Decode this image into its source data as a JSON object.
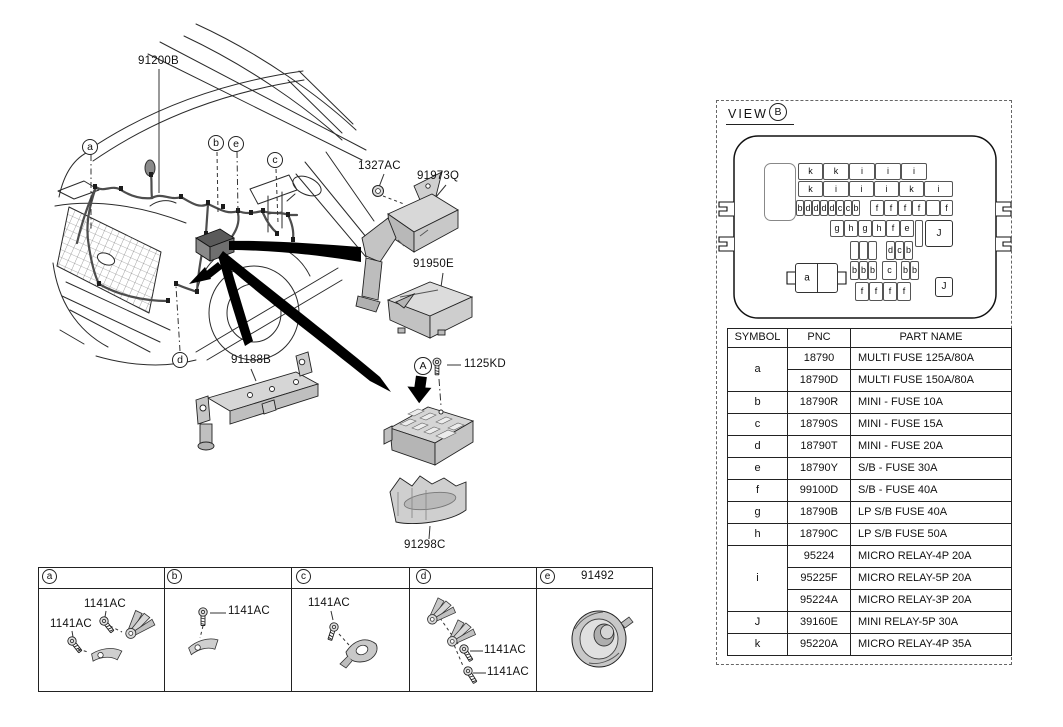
{
  "diagram": {
    "labels": {
      "harness": "91200B",
      "front_bracket": "91188B",
      "nut": "1327AC",
      "upper_bracket": "91973Q",
      "upper_cover": "91950E",
      "mounting_bolt": "1125KD",
      "lower_cover": "91298C"
    },
    "callouts": {
      "car": [
        "a",
        "b",
        "e",
        "c",
        "d"
      ],
      "assembly_point": "A"
    }
  },
  "view_panel": {
    "title": "VIEW",
    "view_letter": "B",
    "battery_label": "a",
    "fuse_cells": [
      {
        "l": "k",
        "x": 798,
        "y": 163,
        "w": 25,
        "h": 17
      },
      {
        "l": "k",
        "x": 823,
        "y": 163,
        "w": 26,
        "h": 17
      },
      {
        "l": "i",
        "x": 849,
        "y": 163,
        "w": 26,
        "h": 17
      },
      {
        "l": "i",
        "x": 875,
        "y": 163,
        "w": 26,
        "h": 17
      },
      {
        "l": "i",
        "x": 901,
        "y": 163,
        "w": 26,
        "h": 17
      },
      {
        "l": "k",
        "x": 798,
        "y": 181,
        "w": 25,
        "h": 16
      },
      {
        "l": "i",
        "x": 823,
        "y": 181,
        "w": 26,
        "h": 16
      },
      {
        "l": "i",
        "x": 849,
        "y": 181,
        "w": 25,
        "h": 16
      },
      {
        "l": "i",
        "x": 874,
        "y": 181,
        "w": 25,
        "h": 16
      },
      {
        "l": "k",
        "x": 899,
        "y": 181,
        "w": 25,
        "h": 16
      },
      {
        "l": "i",
        "x": 924,
        "y": 181,
        "w": 29,
        "h": 16
      },
      {
        "l": "b",
        "x": 796,
        "y": 200,
        "w": 8,
        "h": 16
      },
      {
        "l": "d",
        "x": 804,
        "y": 200,
        "w": 8,
        "h": 16
      },
      {
        "l": "d",
        "x": 812,
        "y": 200,
        "w": 8,
        "h": 16
      },
      {
        "l": "d",
        "x": 820,
        "y": 200,
        "w": 8,
        "h": 16
      },
      {
        "l": "d",
        "x": 828,
        "y": 200,
        "w": 8,
        "h": 16
      },
      {
        "l": "c",
        "x": 836,
        "y": 200,
        "w": 8,
        "h": 16
      },
      {
        "l": "c",
        "x": 844,
        "y": 200,
        "w": 8,
        "h": 16
      },
      {
        "l": "b",
        "x": 852,
        "y": 200,
        "w": 8,
        "h": 16
      },
      {
        "l": "f",
        "x": 870,
        "y": 200,
        "w": 14,
        "h": 16
      },
      {
        "l": "f",
        "x": 884,
        "y": 200,
        "w": 14,
        "h": 16
      },
      {
        "l": "f",
        "x": 898,
        "y": 200,
        "w": 14,
        "h": 16
      },
      {
        "l": "f",
        "x": 912,
        "y": 200,
        "w": 14,
        "h": 16
      },
      {
        "l": "",
        "x": 926,
        "y": 200,
        "w": 14,
        "h": 16
      },
      {
        "l": "f",
        "x": 940,
        "y": 200,
        "w": 13,
        "h": 16
      },
      {
        "l": "g",
        "x": 830,
        "y": 220,
        "w": 14,
        "h": 17
      },
      {
        "l": "h",
        "x": 844,
        "y": 220,
        "w": 14,
        "h": 17
      },
      {
        "l": "g",
        "x": 858,
        "y": 220,
        "w": 14,
        "h": 17
      },
      {
        "l": "h",
        "x": 872,
        "y": 220,
        "w": 14,
        "h": 17
      },
      {
        "l": "f",
        "x": 886,
        "y": 220,
        "w": 14,
        "h": 17
      },
      {
        "l": "e",
        "x": 900,
        "y": 220,
        "w": 14,
        "h": 17
      },
      {
        "l": "",
        "x": 915,
        "y": 220,
        "w": 8,
        "h": 27
      },
      {
        "l": "J",
        "x": 925,
        "y": 220,
        "w": 28,
        "h": 27,
        "j": true
      },
      {
        "l": "",
        "x": 850,
        "y": 241,
        "w": 9,
        "h": 19
      },
      {
        "l": "",
        "x": 859,
        "y": 241,
        "w": 9,
        "h": 19
      },
      {
        "l": "",
        "x": 868,
        "y": 241,
        "w": 9,
        "h": 19
      },
      {
        "l": "d",
        "x": 886,
        "y": 241,
        "w": 9,
        "h": 19
      },
      {
        "l": "c",
        "x": 895,
        "y": 241,
        "w": 9,
        "h": 19
      },
      {
        "l": "b",
        "x": 904,
        "y": 241,
        "w": 9,
        "h": 19
      },
      {
        "l": "b",
        "x": 850,
        "y": 261,
        "w": 9,
        "h": 19
      },
      {
        "l": "b",
        "x": 859,
        "y": 261,
        "w": 9,
        "h": 19
      },
      {
        "l": "b",
        "x": 868,
        "y": 261,
        "w": 9,
        "h": 19
      },
      {
        "l": "c",
        "x": 882,
        "y": 261,
        "w": 15,
        "h": 19
      },
      {
        "l": "b",
        "x": 901,
        "y": 261,
        "w": 9,
        "h": 19
      },
      {
        "l": "b",
        "x": 910,
        "y": 261,
        "w": 9,
        "h": 19
      },
      {
        "l": "f",
        "x": 855,
        "y": 282,
        "w": 14,
        "h": 19
      },
      {
        "l": "f",
        "x": 869,
        "y": 282,
        "w": 14,
        "h": 19
      },
      {
        "l": "f",
        "x": 883,
        "y": 282,
        "w": 14,
        "h": 19
      },
      {
        "l": "f",
        "x": 897,
        "y": 282,
        "w": 14,
        "h": 19
      },
      {
        "l": "J",
        "x": 935,
        "y": 277,
        "w": 18,
        "h": 20,
        "j": true
      }
    ],
    "table": {
      "headers": [
        "SYMBOL",
        "PNC",
        "PART NAME"
      ],
      "rows": [
        {
          "symbol": "a",
          "span": 2,
          "pnc": "18790",
          "name": "MULTI FUSE 125A/80A"
        },
        {
          "pnc": "18790D",
          "name": "MULTI FUSE 150A/80A"
        },
        {
          "symbol": "b",
          "span": 1,
          "pnc": "18790R",
          "name": "MINI - FUSE 10A"
        },
        {
          "symbol": "c",
          "span": 1,
          "pnc": "18790S",
          "name": "MINI - FUSE 15A"
        },
        {
          "symbol": "d",
          "span": 1,
          "pnc": "18790T",
          "name": "MINI - FUSE 20A"
        },
        {
          "symbol": "e",
          "span": 1,
          "pnc": "18790Y",
          "name": "S/B - FUSE 30A"
        },
        {
          "symbol": "f",
          "span": 1,
          "pnc": "99100D",
          "name": "S/B - FUSE 40A"
        },
        {
          "symbol": "g",
          "span": 1,
          "pnc": "18790B",
          "name": "LP S/B FUSE 40A"
        },
        {
          "symbol": "h",
          "span": 1,
          "pnc": "18790C",
          "name": "LP S/B FUSE 50A"
        },
        {
          "symbol": "i",
          "span": 3,
          "pnc": "95224",
          "name": "MICRO RELAY-4P 20A"
        },
        {
          "pnc": "95225F",
          "name": "MICRO RELAY-5P 20A"
        },
        {
          "pnc": "95224A",
          "name": "MICRO RELAY-3P 20A"
        },
        {
          "symbol": "J",
          "span": 1,
          "pnc": "39160E",
          "name": "MINI RELAY-5P 30A"
        },
        {
          "symbol": "k",
          "span": 1,
          "pnc": "95220A",
          "name": "MICRO RELAY-4P 35A"
        }
      ]
    }
  },
  "fastener_strip": {
    "cells": [
      {
        "letter": "a"
      },
      {
        "letter": "b"
      },
      {
        "letter": "c"
      },
      {
        "letter": "d"
      },
      {
        "letter": "e",
        "part": "91492"
      }
    ],
    "labels": [
      {
        "text": "1141AC",
        "x": 84,
        "y": 598
      },
      {
        "text": "1141AC",
        "x": 50,
        "y": 618
      },
      {
        "text": "1141AC",
        "x": 228,
        "y": 605
      },
      {
        "text": "1141AC",
        "x": 308,
        "y": 597
      },
      {
        "text": "1141AC",
        "x": 484,
        "y": 644
      },
      {
        "text": "1141AC",
        "x": 487,
        "y": 666
      },
      {
        "text": "91492",
        "x": 581,
        "y": 570
      }
    ]
  },
  "colors": {
    "line": "#2b2b2b",
    "arrow": "#000000",
    "part_fill_light": "#d8d8d8",
    "part_fill_mid": "#c2c2c2",
    "part_fill_dark": "#9e9e9e"
  }
}
